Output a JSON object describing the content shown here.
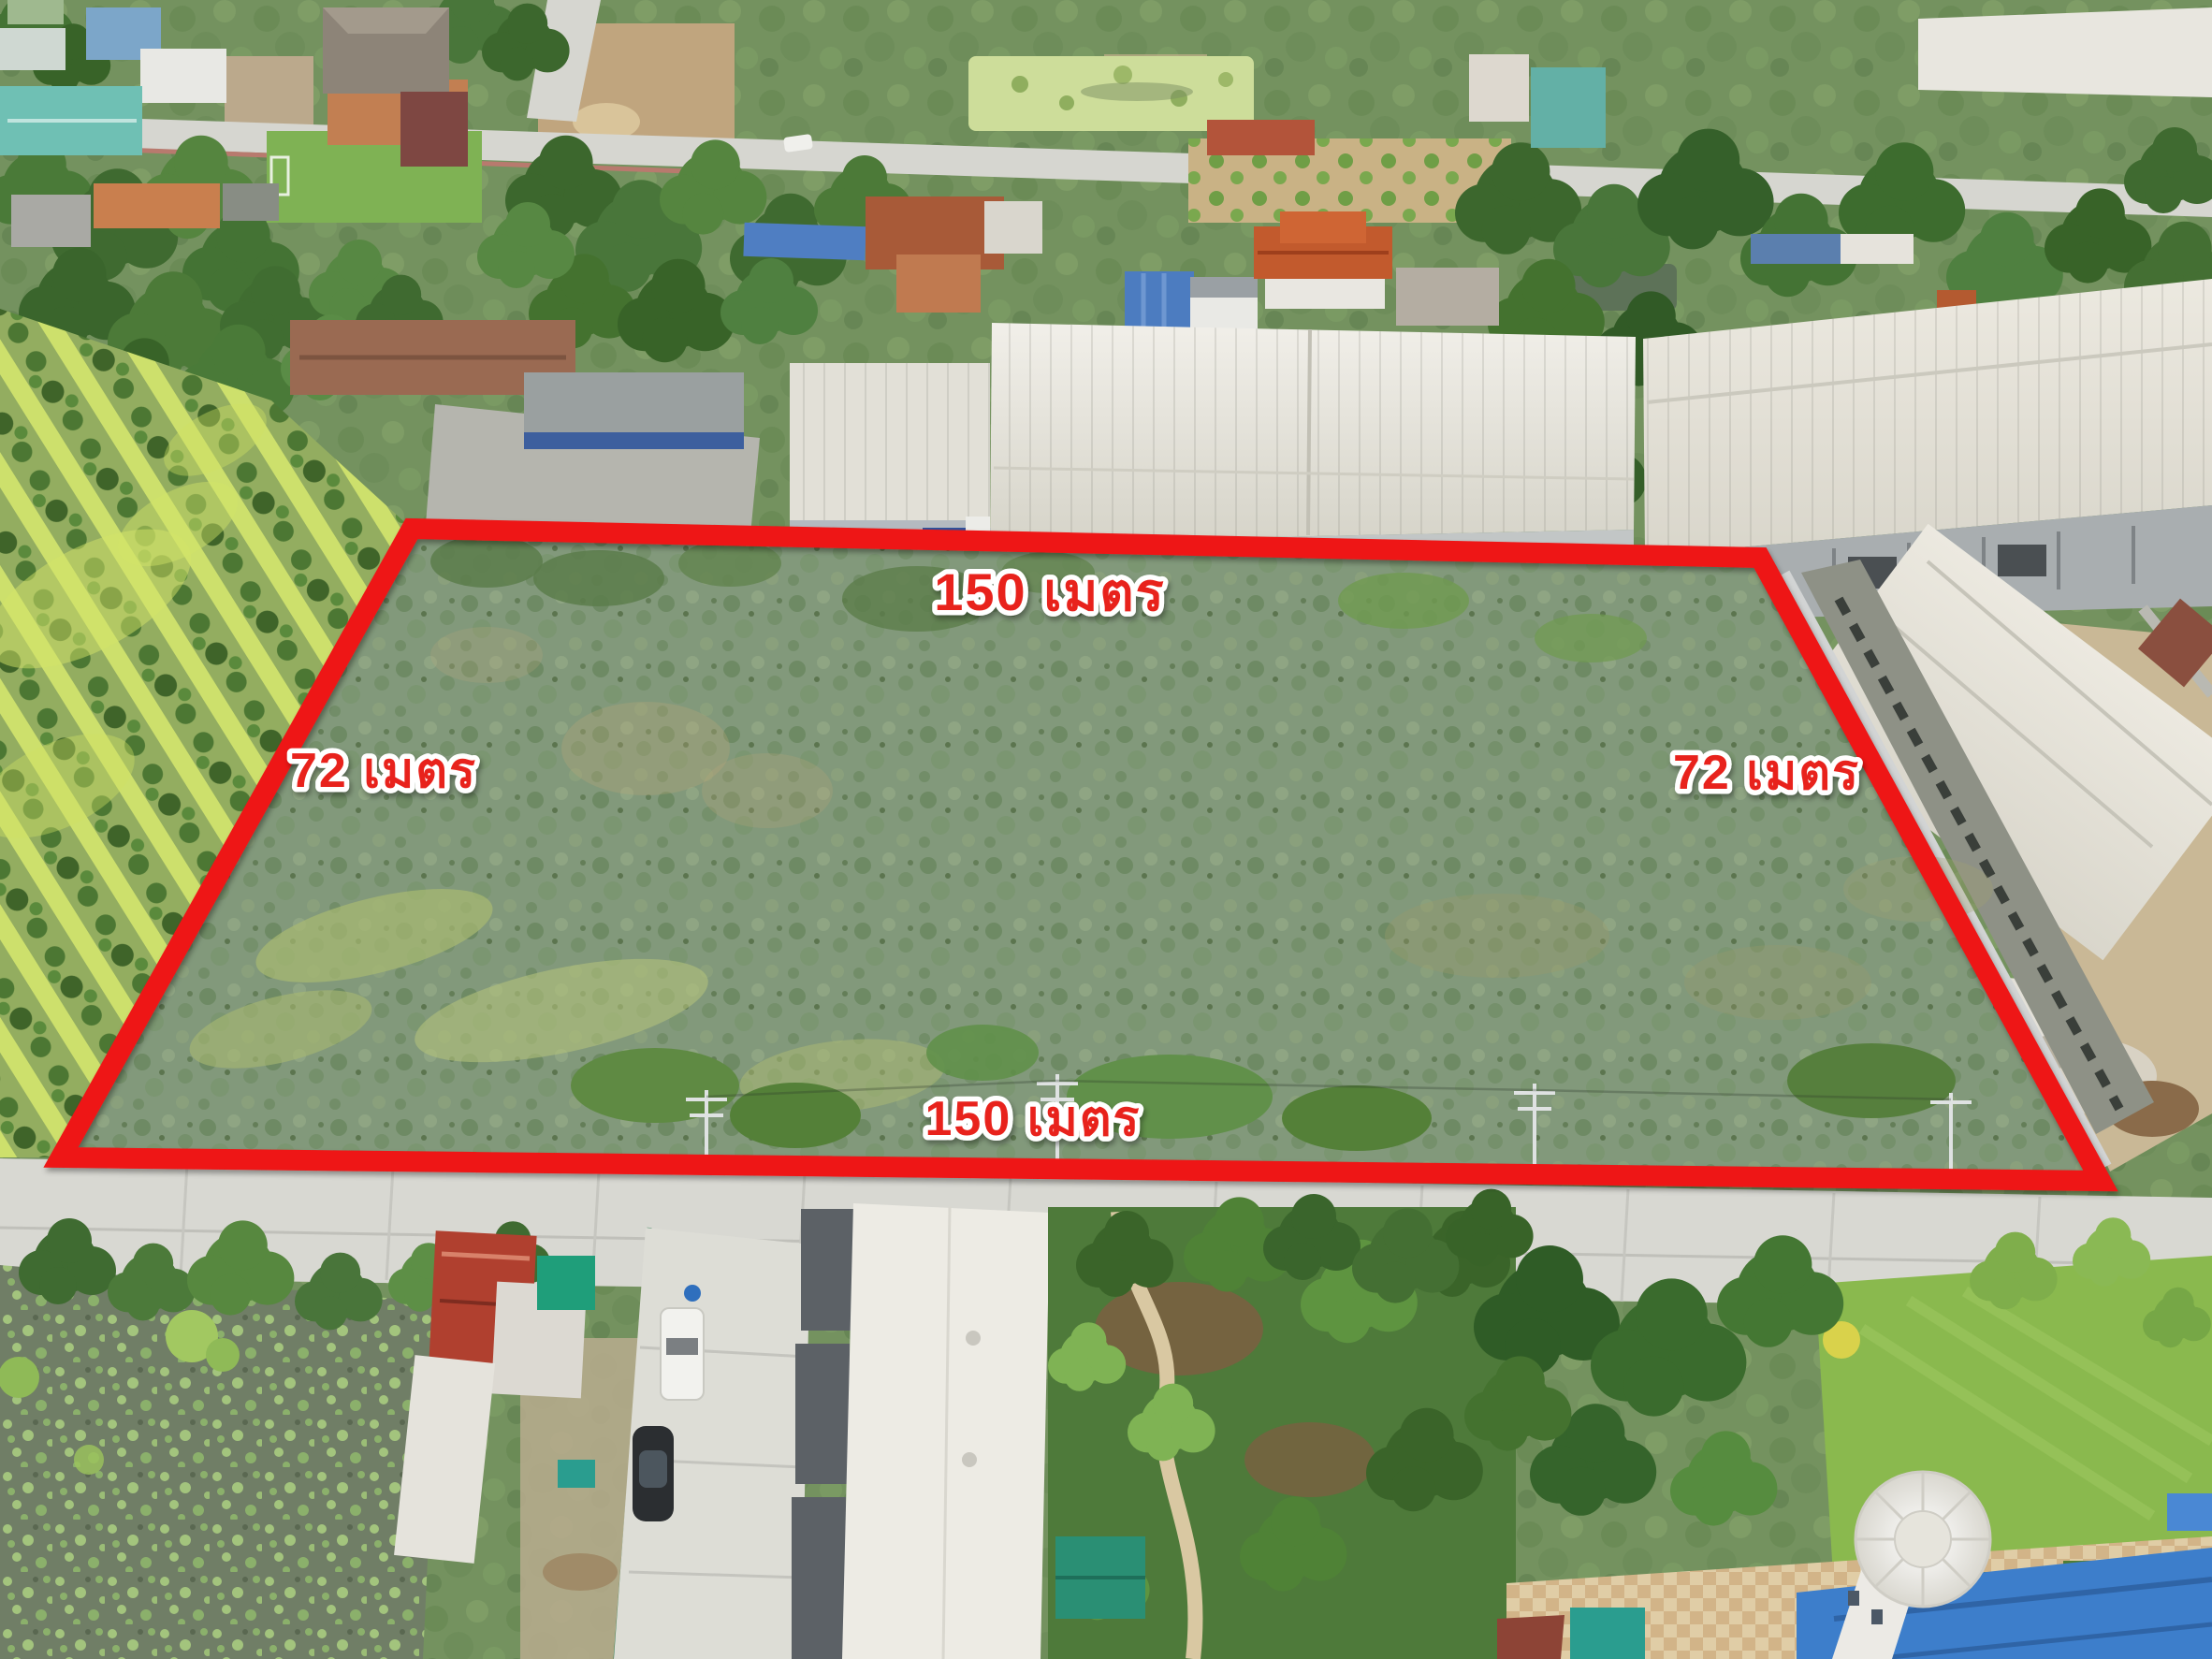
{
  "annotation": {
    "labels": {
      "top": "150 เมตร",
      "right": "72 เมตร",
      "bottom": "150 เมตร",
      "left": "72 เมตร"
    },
    "boundary_color": "#ee1414",
    "label_fill": "#e8231f",
    "label_outline": "#ffffff"
  },
  "scene": {
    "description": "Drone aerial photo of a vacant scrub-covered land plot outlined in red, bordered by a concrete road, factories, houses, dragon fruit farm and lotus ponds",
    "colors": {
      "plot_scrub": "#81987a",
      "road_concrete": "#d8d8d2",
      "factory_roof": "#e7e5dc",
      "lotus_pond": "#707e66",
      "lawn": "#8ab94e",
      "blue_roof": "#3d7ecb",
      "dragon_fruit_rows": "#93ad60"
    }
  }
}
